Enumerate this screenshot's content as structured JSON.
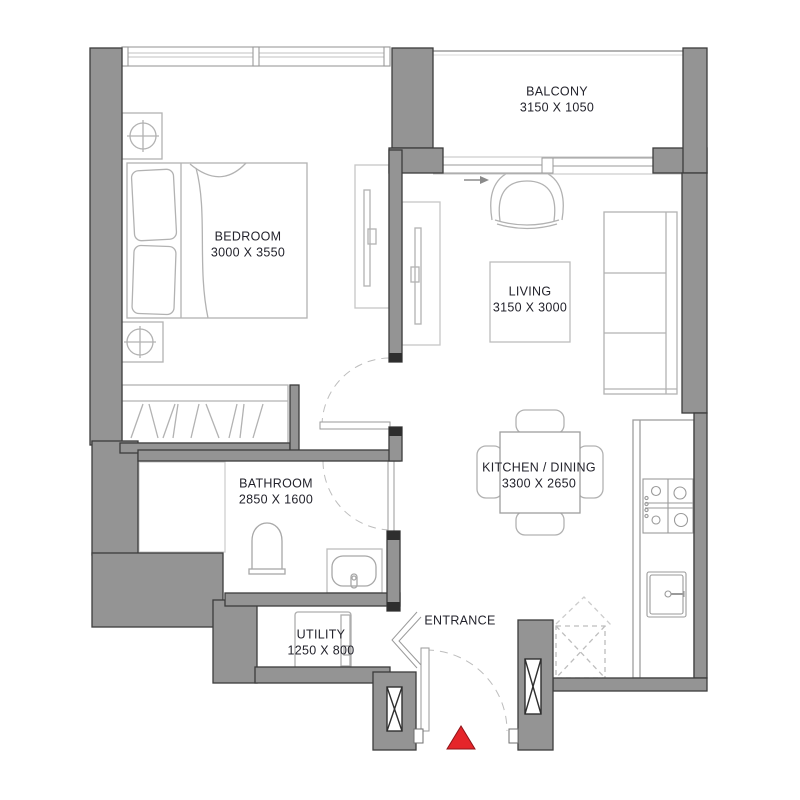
{
  "rooms": [
    {
      "id": "bedroom",
      "label": "BEDROOM",
      "dims": "3000 X 3550"
    },
    {
      "id": "balcony",
      "label": "BALCONY",
      "dims": "3150 X 1050"
    },
    {
      "id": "living",
      "label": "LIVING",
      "dims": "3150 X 3000"
    },
    {
      "id": "kitchen-dining",
      "label": "KITCHEN / DINING",
      "dims": "3300 X 2650"
    },
    {
      "id": "bathroom",
      "label": "BATHROOM",
      "dims": "2850 X 1600"
    },
    {
      "id": "utility",
      "label": "UTILITY",
      "dims": "1250 X 800"
    }
  ],
  "entrance": {
    "label": "ENTRANCE"
  },
  "marker": {
    "name": "entrance-direction-marker",
    "color": "#e5252a",
    "border": "#8f1318"
  },
  "colors": {
    "wall_fill": "#949494",
    "wall_outline": "#3c3c3c",
    "furniture_line": "#b2b2b2",
    "frame_line": "#9a9a9a",
    "label_text": "#23232c",
    "background": "#ffffff"
  },
  "symbols": [
    "double-bed",
    "pillow",
    "ceiling-lamp",
    "wardrobe-hangers",
    "sliding-panel",
    "door-swing",
    "bifold-door",
    "sliding-balcony-door",
    "armchair",
    "sofa",
    "coffee-table",
    "dining-table",
    "chair",
    "gas-hob",
    "kitchen-sink",
    "appliance-space",
    "washing-machine",
    "toilet",
    "basin",
    "structural-column",
    "window",
    "balcony-railing",
    "entrance-triangle"
  ]
}
